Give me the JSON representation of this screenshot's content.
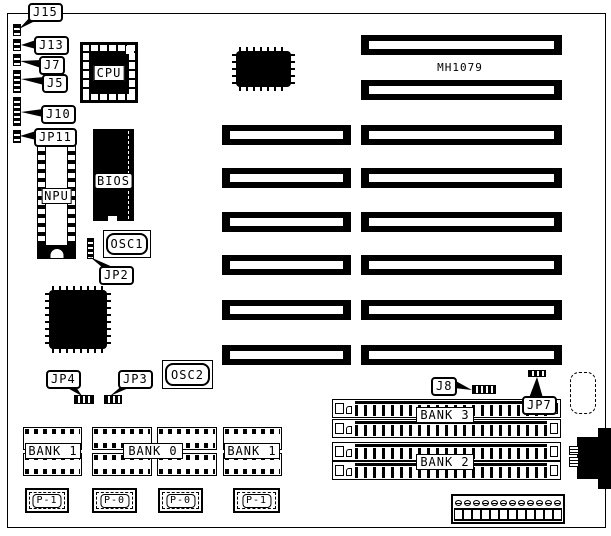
{
  "board": {
    "model": "MH1079"
  },
  "callouts": {
    "j15": "J15",
    "j13": "J13",
    "j7": "J7",
    "j5": "J5",
    "j10": "J10",
    "jp11": "JP11",
    "jp2": "JP2",
    "jp4": "JP4",
    "jp3": "JP3",
    "j8": "J8",
    "jp7": "JP7"
  },
  "chips": {
    "cpu": "CPU",
    "bios": "BIOS",
    "npu": "NPU",
    "osc1": "OSC1",
    "osc2": "OSC2"
  },
  "memory_banks": {
    "bank1_left": "BANK 1",
    "bank0": "BANK 0",
    "bank1_right": "BANK 1",
    "bank3": "BANK 3",
    "bank2": "BANK 2"
  },
  "connectors": {
    "p1_left": "P-1",
    "p0_left": "P-0",
    "p0_right": "P-0",
    "p1_right": "P-1"
  },
  "power_connector": {
    "top_pin_count": 12,
    "bottom_pin_count": 12
  },
  "colors": {
    "ink": "#000000",
    "paper": "#ffffff"
  }
}
